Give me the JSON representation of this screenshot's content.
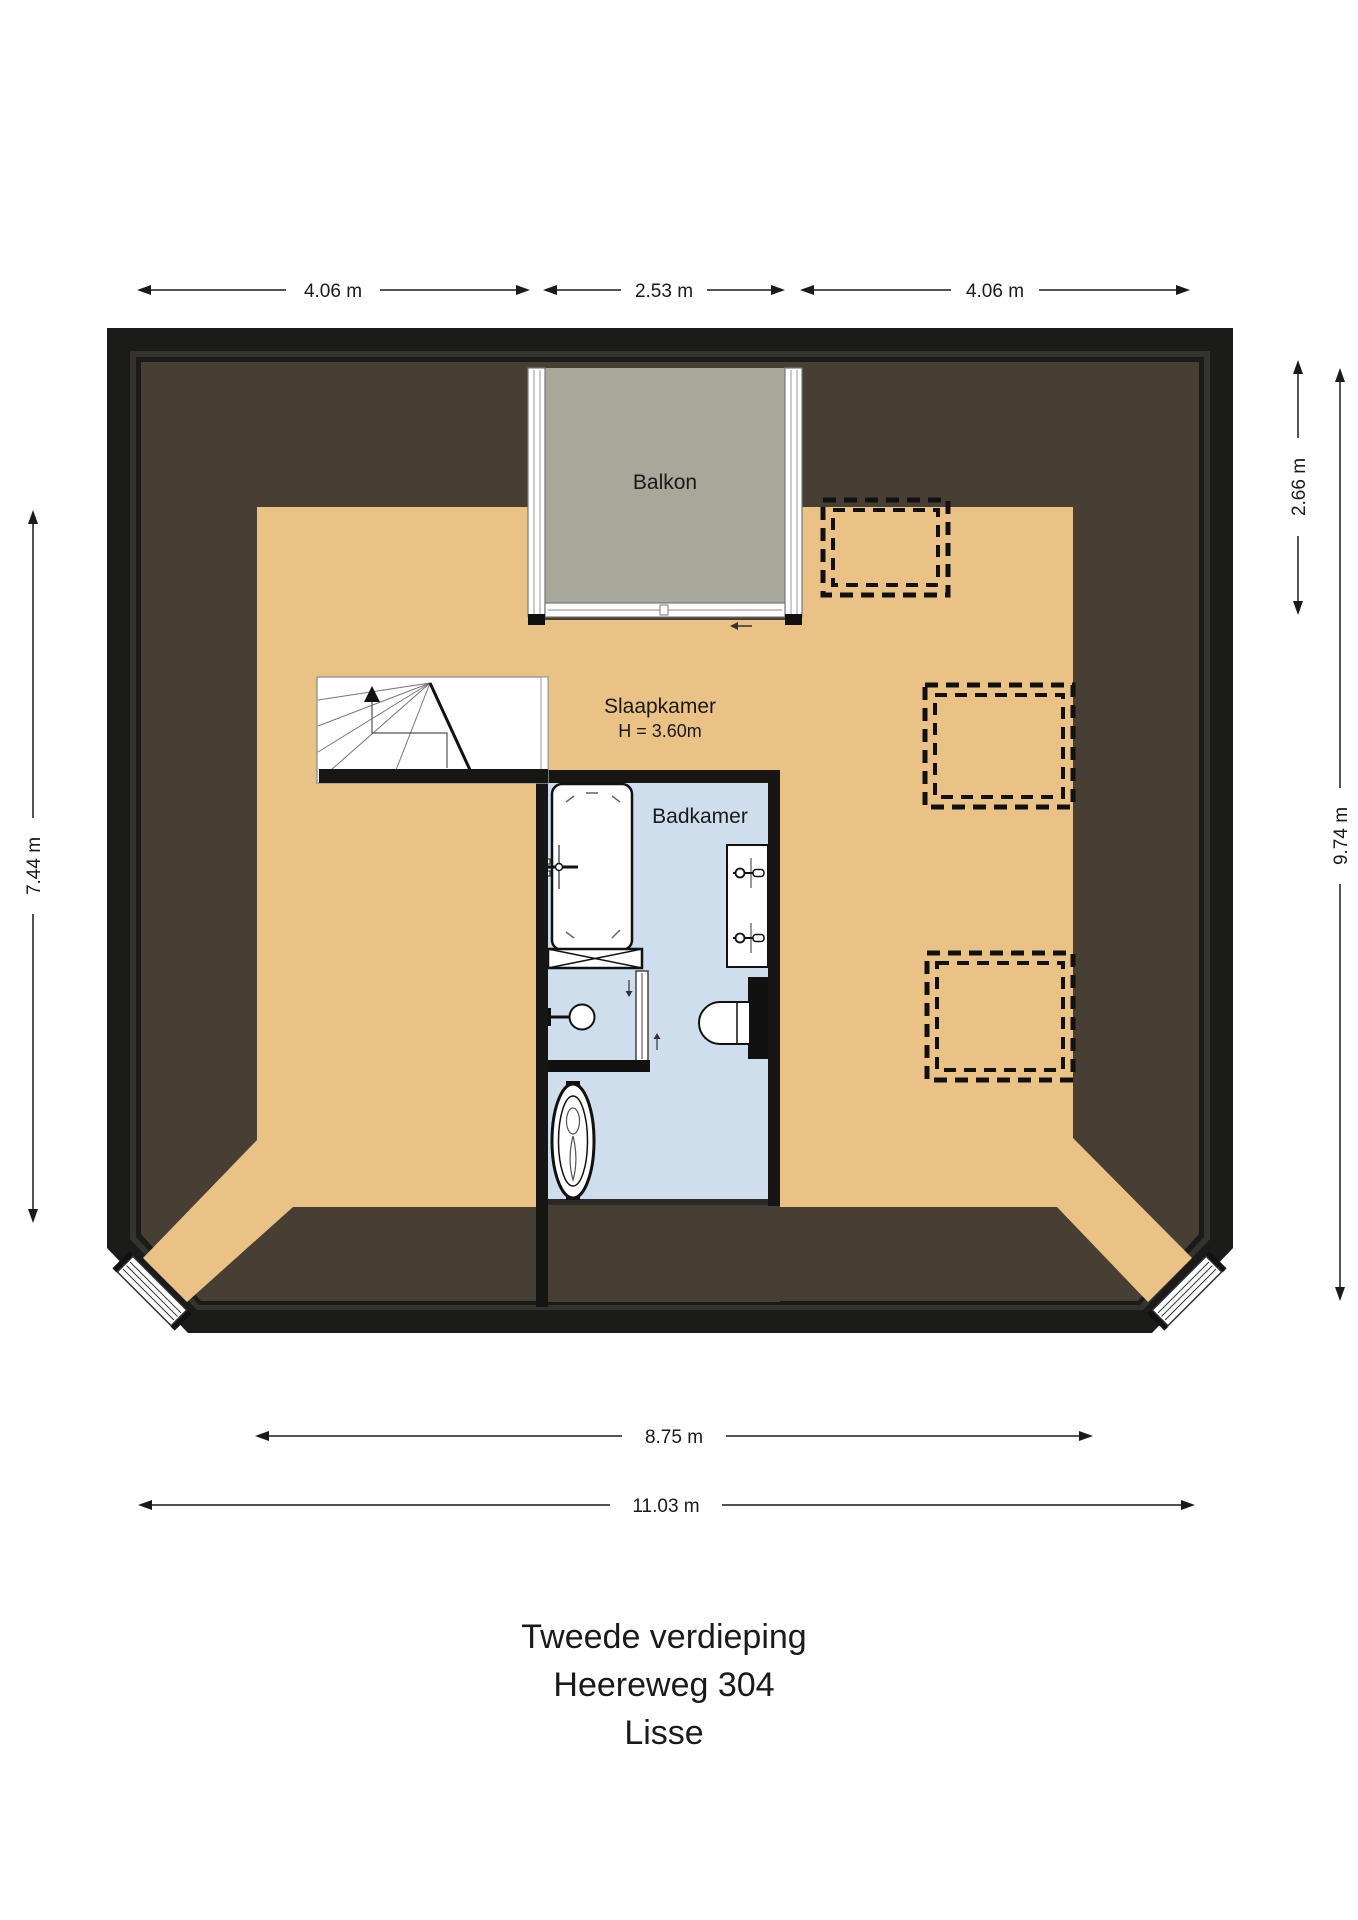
{
  "labels": {
    "balcony": "Balkon",
    "bedroom": "Slaapkamer",
    "bedroom_height": "H = 3.60m",
    "bathroom": "Badkamer",
    "dim_top_left": "4.06 m",
    "dim_top_center": "2.53 m",
    "dim_top_right": "4.06 m",
    "dim_right_upper": "2.66 m",
    "dim_right_full": "9.74 m",
    "dim_left": "7.44 m",
    "dim_bottom_inner": "8.75 m",
    "dim_bottom_outer": "11.03 m",
    "title_1": "Tweede verdieping",
    "title_2": "Heereweg 304",
    "title_3": "Lisse"
  },
  "colors": {
    "wall": "#1b1b19",
    "wall_shadow": "#35332e",
    "roof_slope": "#473f33",
    "floor": "#eac286",
    "balcony": "#a7a79a",
    "bathroom": "#cedeec",
    "fixture_fill": "#ffffff",
    "fixture_stroke": "#111111"
  }
}
